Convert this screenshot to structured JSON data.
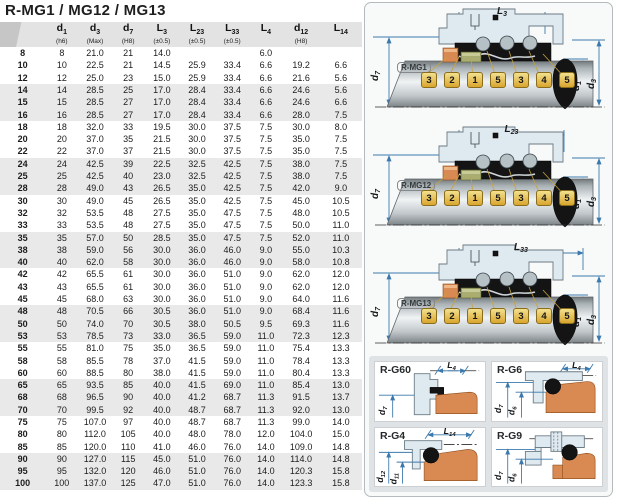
{
  "title": "R-MG1 / MG12 / MG13",
  "table": {
    "headers": [
      {
        "base": "",
        "sub": "",
        "note": ""
      },
      {
        "base": "d",
        "sub": "1",
        "note": "(h6)"
      },
      {
        "base": "d",
        "sub": "3",
        "note": "(Max)"
      },
      {
        "base": "d",
        "sub": "7",
        "note": "(H8)"
      },
      {
        "base": "L",
        "sub": "3",
        "note": "(±0.5)"
      },
      {
        "base": "L",
        "sub": "23",
        "note": "(±0.5)"
      },
      {
        "base": "L",
        "sub": "33",
        "note": "(±0.5)"
      },
      {
        "base": "L",
        "sub": "4",
        "note": ""
      },
      {
        "base": "d",
        "sub": "12",
        "note": "(H8)"
      },
      {
        "base": "L",
        "sub": "14",
        "note": ""
      }
    ],
    "rows": [
      [
        "8",
        "8",
        "21.0",
        "21",
        "14.0",
        "",
        "",
        "6.0",
        "",
        ""
      ],
      [
        "10",
        "10",
        "22.5",
        "21",
        "14.5",
        "25.9",
        "33.4",
        "6.6",
        "19.2",
        "6.6"
      ],
      [
        "12",
        "12",
        "25.0",
        "23",
        "15.0",
        "25.9",
        "33.4",
        "6.6",
        "21.6",
        "5.6"
      ],
      [
        "14",
        "14",
        "28.5",
        "25",
        "17.0",
        "28.4",
        "33.4",
        "6.6",
        "24.6",
        "5.6"
      ],
      [
        "15",
        "15",
        "28.5",
        "27",
        "17.0",
        "28.4",
        "33.4",
        "6.6",
        "24.6",
        "6.6"
      ],
      [
        "16",
        "16",
        "28.5",
        "27",
        "17.0",
        "28.4",
        "33.4",
        "6.6",
        "28.0",
        "7.5"
      ],
      [
        "18",
        "18",
        "32.0",
        "33",
        "19.5",
        "30.0",
        "37.5",
        "7.5",
        "30.0",
        "8.0"
      ],
      [
        "20",
        "20",
        "37.0",
        "35",
        "21.5",
        "30.0",
        "37.5",
        "7.5",
        "35.0",
        "7.5"
      ],
      [
        "22",
        "22",
        "37.0",
        "37",
        "21.5",
        "30.0",
        "37.5",
        "7.5",
        "35.0",
        "7.5"
      ],
      [
        "24",
        "24",
        "42.5",
        "39",
        "22.5",
        "32.5",
        "42.5",
        "7.5",
        "38.0",
        "7.5"
      ],
      [
        "25",
        "25",
        "42.5",
        "40",
        "23.0",
        "32.5",
        "42.5",
        "7.5",
        "38.0",
        "7.5"
      ],
      [
        "28",
        "28",
        "49.0",
        "43",
        "26.5",
        "35.0",
        "42.5",
        "7.5",
        "42.0",
        "9.0"
      ],
      [
        "30",
        "30",
        "49.0",
        "45",
        "26.5",
        "35.0",
        "42.5",
        "7.5",
        "45.0",
        "10.5"
      ],
      [
        "32",
        "32",
        "53.5",
        "48",
        "27.5",
        "35.0",
        "47.5",
        "7.5",
        "48.0",
        "10.5"
      ],
      [
        "33",
        "33",
        "53.5",
        "48",
        "27.5",
        "35.0",
        "47.5",
        "7.5",
        "50.0",
        "11.0"
      ],
      [
        "35",
        "35",
        "57.0",
        "50",
        "28.5",
        "35.0",
        "47.5",
        "7.5",
        "52.0",
        "11.0"
      ],
      [
        "38",
        "38",
        "59.0",
        "56",
        "30.0",
        "36.0",
        "46.0",
        "9.0",
        "55.0",
        "10.3"
      ],
      [
        "40",
        "40",
        "62.0",
        "58",
        "30.0",
        "36.0",
        "46.0",
        "9.0",
        "58.0",
        "10.8"
      ],
      [
        "42",
        "42",
        "65.5",
        "61",
        "30.0",
        "36.0",
        "51.0",
        "9.0",
        "62.0",
        "12.0"
      ],
      [
        "43",
        "43",
        "65.5",
        "61",
        "30.0",
        "36.0",
        "51.0",
        "9.0",
        "62.0",
        "12.0"
      ],
      [
        "45",
        "45",
        "68.0",
        "63",
        "30.0",
        "36.0",
        "51.0",
        "9.0",
        "64.0",
        "11.6"
      ],
      [
        "48",
        "48",
        "70.5",
        "66",
        "30.5",
        "36.0",
        "51.0",
        "9.0",
        "68.4",
        "11.6"
      ],
      [
        "50",
        "50",
        "74.0",
        "70",
        "30.5",
        "38.0",
        "50.5",
        "9.5",
        "69.3",
        "11.6"
      ],
      [
        "53",
        "53",
        "78.5",
        "73",
        "33.0",
        "36.5",
        "59.0",
        "11.0",
        "72.3",
        "12.3"
      ],
      [
        "55",
        "55",
        "81.0",
        "75",
        "35.0",
        "36.5",
        "59.0",
        "11.0",
        "75.4",
        "13.3"
      ],
      [
        "58",
        "58",
        "85.5",
        "78",
        "37.0",
        "41.5",
        "59.0",
        "11.0",
        "78.4",
        "13.3"
      ],
      [
        "60",
        "60",
        "88.5",
        "80",
        "38.0",
        "41.5",
        "59.0",
        "11.0",
        "80.4",
        "13.3"
      ],
      [
        "65",
        "65",
        "93.5",
        "85",
        "40.0",
        "41.5",
        "69.0",
        "11.0",
        "85.4",
        "13.0"
      ],
      [
        "68",
        "68",
        "96.5",
        "90",
        "40.0",
        "41.2",
        "68.7",
        "11.3",
        "91.5",
        "13.7"
      ],
      [
        "70",
        "70",
        "99.5",
        "92",
        "40.0",
        "48.7",
        "68.7",
        "11.3",
        "92.0",
        "13.0"
      ],
      [
        "75",
        "75",
        "107.0",
        "97",
        "40.0",
        "48.7",
        "68.7",
        "11.3",
        "99.0",
        "14.0"
      ],
      [
        "80",
        "80",
        "112.0",
        "105",
        "40.0",
        "48.0",
        "78.0",
        "12.0",
        "104.0",
        "15.0"
      ],
      [
        "85",
        "85",
        "120.0",
        "110",
        "41.0",
        "46.0",
        "76.0",
        "14.0",
        "109.0",
        "14.8"
      ],
      [
        "90",
        "90",
        "127.0",
        "115",
        "45.0",
        "51.0",
        "76.0",
        "14.0",
        "114.0",
        "14.8"
      ],
      [
        "95",
        "95",
        "132.0",
        "120",
        "46.0",
        "51.0",
        "76.0",
        "14.0",
        "120.3",
        "15.8"
      ],
      [
        "100",
        "100",
        "137.0",
        "125",
        "47.0",
        "51.0",
        "76.0",
        "14.0",
        "123.3",
        "15.8"
      ]
    ]
  },
  "diagrams": [
    {
      "label": "R-MG1",
      "dim_top": {
        "base": "L",
        "sub": "3"
      },
      "dim_left": {
        "base": "d",
        "sub": "7"
      },
      "dim_right1": {
        "base": "d",
        "sub": "1"
      },
      "dim_right2": {
        "base": "d",
        "sub": "3"
      },
      "callouts": [
        "3",
        "2",
        "1",
        "5",
        "3",
        "4",
        "5"
      ]
    },
    {
      "label": "R-MG12",
      "dim_top": {
        "base": "L",
        "sub": "23"
      },
      "dim_left": {
        "base": "d",
        "sub": "7"
      },
      "dim_right1": {
        "base": "d",
        "sub": "1"
      },
      "dim_right2": {
        "base": "d",
        "sub": "3"
      },
      "callouts": [
        "3",
        "2",
        "1",
        "5",
        "3",
        "4",
        "5"
      ]
    },
    {
      "label": "R-MG13",
      "dim_top": {
        "base": "L",
        "sub": "33"
      },
      "dim_left": {
        "base": "d",
        "sub": "7"
      },
      "dim_right1": {
        "base": "d",
        "sub": "1"
      },
      "dim_right2": {
        "base": "d",
        "sub": "3"
      },
      "callouts": [
        "3",
        "2",
        "1",
        "5",
        "3",
        "4",
        "5"
      ]
    }
  ],
  "cards": [
    {
      "label": "R-G60",
      "dim_top": {
        "base": "L",
        "sub": "4"
      },
      "dim_left1": {
        "base": "d",
        "sub": "7"
      }
    },
    {
      "label": "R-G6",
      "dim_top": {
        "base": "L",
        "sub": "4"
      },
      "dim_left1": {
        "base": "d",
        "sub": "7"
      },
      "dim_left2": {
        "base": "d",
        "sub": "6"
      }
    },
    {
      "label": "R-G4",
      "dim_top": {
        "base": "L",
        "sub": "14"
      },
      "dim_left1": {
        "base": "d",
        "sub": "12"
      },
      "dim_left2": {
        "base": "d",
        "sub": "11"
      }
    },
    {
      "label": "R-G9",
      "dim_left1": {
        "base": "d",
        "sub": "7"
      },
      "dim_left2": {
        "base": "d",
        "sub": "6"
      }
    }
  ],
  "colors": {
    "dim_line": "#3b79ad",
    "housing_fill": "#dfe9f0",
    "housing_stroke": "#6b7b85",
    "rubber_black": "#141414",
    "seat_orange": "#d98a52",
    "face_olive": "#a9ad72",
    "chip_gold_light": "#f3e08e",
    "chip_gold_dark": "#d9a62e",
    "chip_border": "#8a6d1a",
    "leader_line": "#c8a23c",
    "header_bg": "#e3e3e3",
    "row_band": "#e9e9e9",
    "panel_border": "#b5babd",
    "cards_bg": "#dfe3e5"
  }
}
